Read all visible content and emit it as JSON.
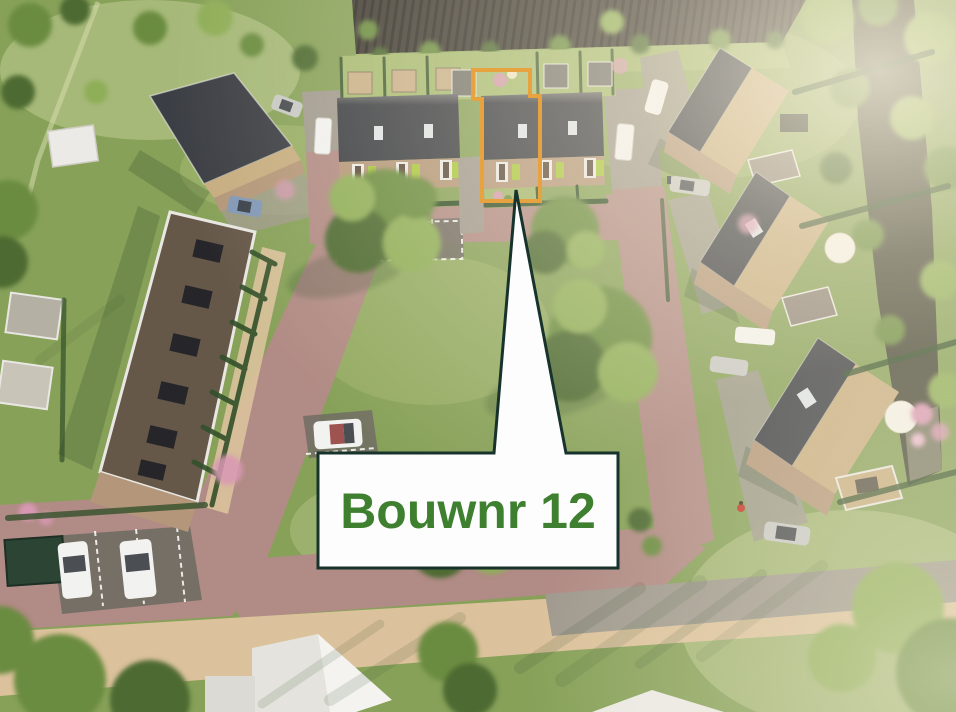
{
  "callout": {
    "label": "Bouwnr 12",
    "text_color": "#3f8030",
    "box_fill": "#fdfdfd",
    "border_color": "#18332c"
  },
  "highlight": {
    "outline_color": "#e7a33f",
    "outline_width": 4
  },
  "palette": {
    "grass_base": "#87a159",
    "grass_light": "#a7bb72",
    "grass_pale": "#cdd7a0",
    "field_dark": "#3e3a33",
    "road_brick": "#b18b85",
    "path_sand": "#dcc29c",
    "gravel_grey": "#a09a8f",
    "pavement_dark": "#716c64",
    "roof_dark": "#3b3e44",
    "roof_tan": "#c7ad80",
    "roof_flat_brown": "#665849",
    "trim_white": "#e9e7e2",
    "facade_brick": "#b4977a",
    "accent_lime": "#a9c83e",
    "hedge_dark": "#33502a",
    "tree_dark": "#4e6b31",
    "tree_green": "#6b8c41",
    "tree_light": "#8fae58",
    "water_dark": "#49493a",
    "shed_grey": "#b5b0a4",
    "building_white": "#eceae6",
    "car_white": "#f2f2f0",
    "car_silver": "#c8c9c6",
    "car_dark": "#3c3f42",
    "container_green": "#2c4434",
    "flower_pink": "#d898b4",
    "haze": "#fdf6e8"
  },
  "scene": {
    "description": "aerial 3D render of a new-build housing development",
    "objects": [
      "plowed-field",
      "canal",
      "terraced-row-building",
      "terraced-house-block-left",
      "terraced-house-block-right",
      "highlighted-plot",
      "detached-house-1",
      "detached-house-2",
      "detached-house-3",
      "courtyard-lawn",
      "parking-areas",
      "brick-roads",
      "sand-footpath",
      "garden-sheds",
      "cars",
      "trees",
      "callout-label"
    ]
  }
}
